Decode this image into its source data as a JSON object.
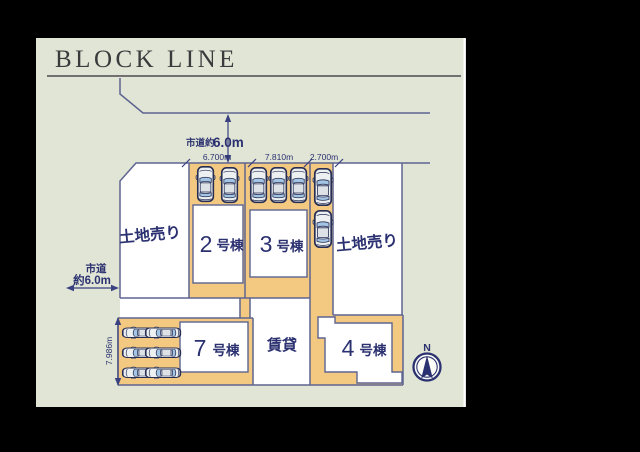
{
  "title": "BLOCK LINE",
  "top_road": {
    "prefix": "市道約",
    "value": "6.0m"
  },
  "left_road": {
    "line1": "市道",
    "line2": "約6.0m"
  },
  "top_dims": [
    "6.700m",
    "7.810m",
    "2.700m"
  ],
  "left_dim": "7.986m",
  "plots": {
    "land_left": "土地売り",
    "land_right": "土地売り",
    "rental": "賃貸",
    "unit2": {
      "num": "2",
      "suffix": "号棟"
    },
    "unit3": {
      "num": "3",
      "suffix": "号棟"
    },
    "unit4": {
      "num": "4",
      "suffix": "号棟"
    },
    "unit7": {
      "num": "7",
      "suffix": "号棟"
    }
  },
  "compass": {
    "label": "N"
  },
  "icons": {
    "car": "car-icon",
    "compass": "compass-north-icon"
  },
  "parking": {
    "unit2_cars": 2,
    "unit3_cars": 3,
    "strip_cars": 2,
    "unit7_cars": 6
  },
  "colors": {
    "panel_bg": "#e0e5d5",
    "plot_orange": "#f3c981",
    "plot_white": "#ffffff",
    "boundary": "#5e6490",
    "label_navy": "#2b3170",
    "title_gray": "#3b3b3d"
  }
}
